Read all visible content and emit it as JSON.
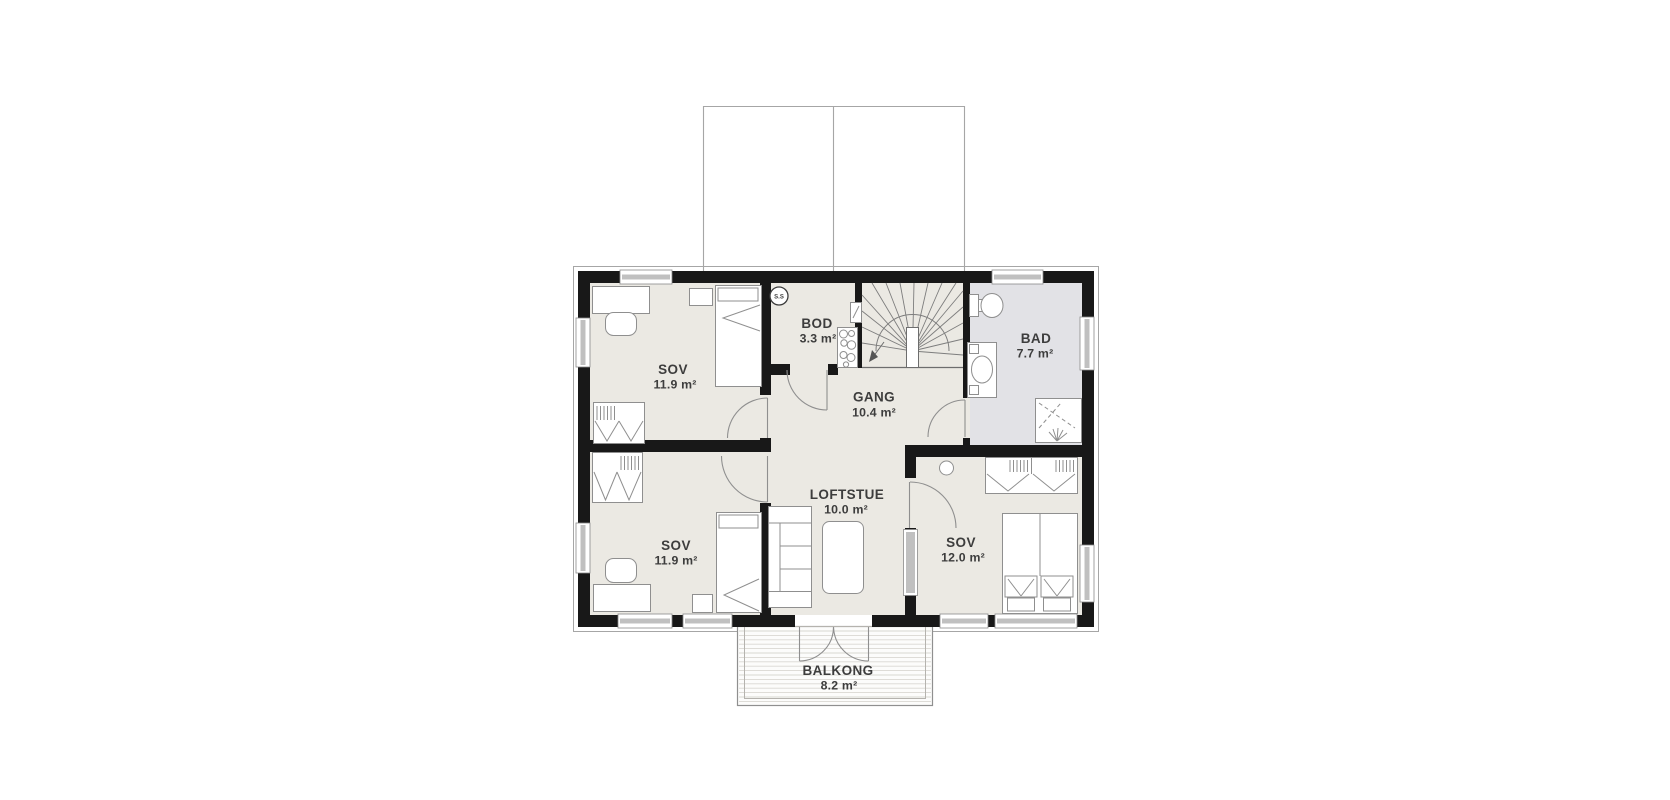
{
  "plan": {
    "type": "floor-plan",
    "rooms": [
      {
        "key": "sov-1",
        "name": "SOV",
        "area": "11.9 m²"
      },
      {
        "key": "sov-2",
        "name": "SOV",
        "area": "11.9 m²"
      },
      {
        "key": "sov-3",
        "name": "SOV",
        "area": "12.0 m²"
      },
      {
        "key": "bod",
        "name": "BOD",
        "area": "3.3 m²"
      },
      {
        "key": "gang",
        "name": "GANG",
        "area": "10.4 m²"
      },
      {
        "key": "loftstue",
        "name": "LOFTSTUE",
        "area": "10.0 m²"
      },
      {
        "key": "bad",
        "name": "BAD",
        "area": "7.7 m²"
      },
      {
        "key": "balkong",
        "name": "BALKONG",
        "area": "8.2 m²"
      }
    ],
    "annotations": {
      "smoke_detector_label": "S.S"
    },
    "colors": {
      "wall": "#181818",
      "floor": "#ebe9e3",
      "bathroom_floor": "#e2e2e6",
      "balcony_floor": "#fcfcfb",
      "window_glass": "#c0c0c0",
      "line": "#8f8f8f",
      "outline": "#a6a6a6",
      "deck_line": "#d9d7d2",
      "text": "#3d3d3d"
    }
  }
}
